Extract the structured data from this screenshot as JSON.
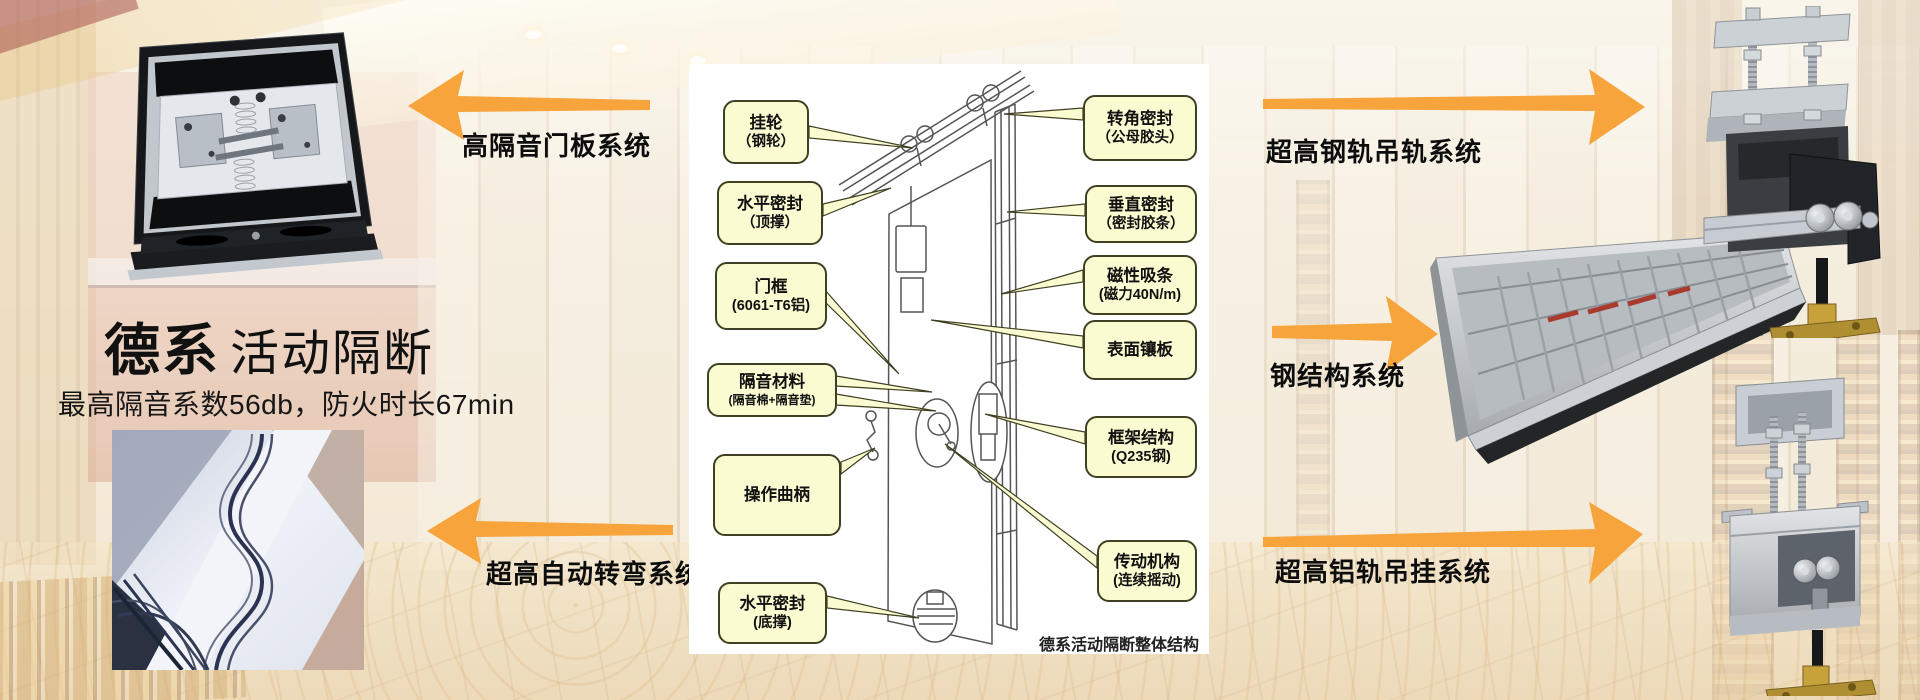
{
  "title": {
    "brand": "德系",
    "name": "活动隔断",
    "subtitle": "最高隔音系数56db，防火时长67min"
  },
  "arrows": {
    "top_left": {
      "label": "高隔音门板系统"
    },
    "bottom_left": {
      "label": "超高自动转弯系统"
    },
    "top_right": {
      "label": "超高钢轨吊轨系统"
    },
    "mid_right": {
      "label": "钢结构系统"
    },
    "bottom_right": {
      "label": "超高铝轨吊挂系统"
    }
  },
  "diagram": {
    "caption": "德系活动隔断整体结构",
    "left_labels": [
      {
        "line1": "挂轮",
        "line2": "（钢轮）"
      },
      {
        "line1": "水平密封",
        "line2": "（顶撑）"
      },
      {
        "line1": "门框",
        "line2": "(6061-T6铝)"
      },
      {
        "line1": "隔音材料",
        "line2": "(隔音棉+隔音垫)"
      },
      {
        "line1": "操作曲柄"
      },
      {
        "line1": "水平密封",
        "line2": "(底撑)"
      }
    ],
    "right_labels": [
      {
        "line1": "转角密封",
        "line2": "（公母胶头）"
      },
      {
        "line1": "垂直密封",
        "line2": "（密封胶条）"
      },
      {
        "line1": "磁性吸条",
        "line2": "(磁力40N/m)"
      },
      {
        "line1": "表面镶板"
      },
      {
        "line1": "框架结构",
        "line2": "(Q235钢)"
      },
      {
        "line1": "传动机构",
        "line2": "(连续摇动)"
      }
    ]
  },
  "colors": {
    "arrow_orange": "#F6A43B",
    "callout_fill": "#FBFBD2",
    "callout_border": "#3F3F22",
    "panel_bg": "#FFFFFF",
    "text": "#111111"
  }
}
